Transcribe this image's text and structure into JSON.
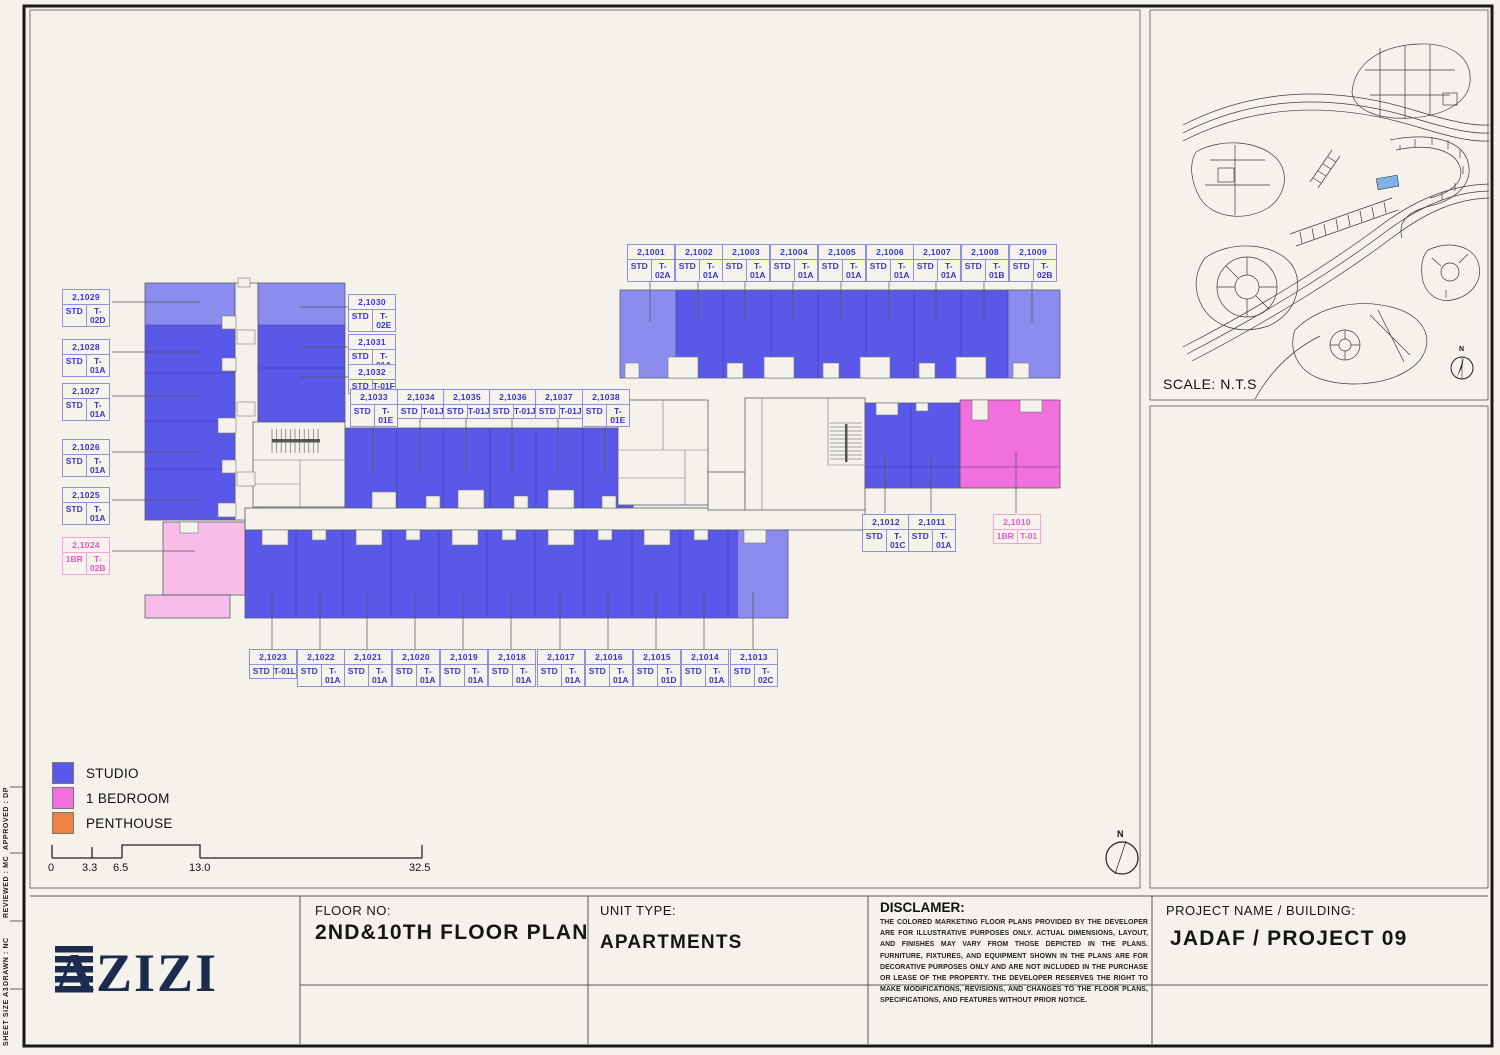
{
  "colors": {
    "paper": "#f4f2ea",
    "studio": "#5a58e8",
    "studio_light": "#8c8cee",
    "one_bed": "#f170dd",
    "one_bed_light": "#f8bce9",
    "penthouse": "#ee8345",
    "map_highlight": "#7fb3e3",
    "label_blue": "#3a35cf",
    "label_pink": "#ee55cc",
    "brand_navy": "#1d2b4f"
  },
  "margin_notes": [
    {
      "text": "APPROVED :   DP"
    },
    {
      "text": "REVIEWED :   MC"
    },
    {
      "text": "DRAWN :   NC"
    },
    {
      "text": "SHEET SIZE  A3"
    }
  ],
  "units": {
    "top": [
      {
        "id": "2,1001",
        "t": "STD",
        "p": "T-02A"
      },
      {
        "id": "2,1002",
        "t": "STD",
        "p": "T-01A"
      },
      {
        "id": "2,1003",
        "t": "STD",
        "p": "T-01A"
      },
      {
        "id": "2,1004",
        "t": "STD",
        "p": "T-01A"
      },
      {
        "id": "2,1005",
        "t": "STD",
        "p": "T-01A"
      },
      {
        "id": "2,1006",
        "t": "STD",
        "p": "T-01A"
      },
      {
        "id": "2,1007",
        "t": "STD",
        "p": "T-01A"
      },
      {
        "id": "2,1008",
        "t": "STD",
        "p": "T-01B"
      },
      {
        "id": "2,1009",
        "t": "STD",
        "p": "T-02B"
      }
    ],
    "left": [
      {
        "id": "2,1029",
        "t": "STD",
        "p": "T-02D"
      },
      {
        "id": "2,1028",
        "t": "STD",
        "p": "T-01A"
      },
      {
        "id": "2,1027",
        "t": "STD",
        "p": "T-01A"
      },
      {
        "id": "2,1026",
        "t": "STD",
        "p": "T-01A"
      },
      {
        "id": "2,1025",
        "t": "STD",
        "p": "T-01A"
      }
    ],
    "left1br": {
      "id": "2,1024",
      "t": "1BR",
      "p": "T-02B"
    },
    "mid_stack": [
      {
        "id": "2,1030",
        "t": "STD",
        "p": "T-02E"
      },
      {
        "id": "2,1031",
        "t": "STD",
        "p": "T-01A"
      },
      {
        "id": "2,1032",
        "t": "STD",
        "p": "T-01F"
      }
    ],
    "mid_row": [
      {
        "id": "2,1033",
        "t": "STD",
        "p": "T-01E"
      },
      {
        "id": "2,1034",
        "t": "STD",
        "p": "T-01J"
      },
      {
        "id": "2,1035",
        "t": "STD",
        "p": "T-01J"
      },
      {
        "id": "2,1036",
        "t": "STD",
        "p": "T-01J"
      },
      {
        "id": "2,1037",
        "t": "STD",
        "p": "T-01J"
      },
      {
        "id": "2,1038",
        "t": "STD",
        "p": "T-01E"
      }
    ],
    "bottom": [
      {
        "id": "2,1023",
        "t": "STD",
        "p": "T-01L"
      },
      {
        "id": "2,1022",
        "t": "STD",
        "p": "T-01A"
      },
      {
        "id": "2,1021",
        "t": "STD",
        "p": "T-01A"
      },
      {
        "id": "2,1020",
        "t": "STD",
        "p": "T-01A"
      },
      {
        "id": "2,1019",
        "t": "STD",
        "p": "T-01A"
      },
      {
        "id": "2,1018",
        "t": "STD",
        "p": "T-01A"
      },
      {
        "id": "2,1017",
        "t": "STD",
        "p": "T-01A"
      },
      {
        "id": "2,1016",
        "t": "STD",
        "p": "T-01A"
      },
      {
        "id": "2,1015",
        "t": "STD",
        "p": "T-01D"
      },
      {
        "id": "2,1014",
        "t": "STD",
        "p": "T-01A"
      },
      {
        "id": "2,1013",
        "t": "STD",
        "p": "T-02C"
      }
    ],
    "right": [
      {
        "id": "2,1012",
        "t": "STD",
        "p": "T-01C"
      },
      {
        "id": "2,1011",
        "t": "STD",
        "p": "T-01A"
      }
    ],
    "right1br": {
      "id": "2,1010",
      "t": "1BR",
      "p": "T-01"
    }
  },
  "legend": {
    "items": [
      {
        "label": "STUDIO",
        "color": "#5a58e8"
      },
      {
        "label": "1 BEDROOM",
        "color": "#f170dd"
      },
      {
        "label": "PENTHOUSE",
        "color": "#ee8345"
      }
    ]
  },
  "scalebar": {
    "labels": [
      "0",
      "3.3",
      "6.5",
      "13.0",
      "32.5"
    ]
  },
  "map": {
    "scale_note": "SCALE: N.T.S",
    "north": "N"
  },
  "compass": {
    "north": "N"
  },
  "titleblock": {
    "floor_label": "FLOOR NO:",
    "floor_value": "2ND&10TH FLOOR PLAN",
    "unit_type_label": "UNIT TYPE:",
    "unit_type_value": "APARTMENTS",
    "disclaimer_label": "DISCLAMER:",
    "disclaimer_text": "THE COLORED MARKETING FLOOR PLANS PROVIDED BY THE DEVELOPER ARE FOR ILLUSTRATIVE PURPOSES ONLY. ACTUAL DIMENSIONS, LAYOUT, AND FINISHES MAY VARY FROM THOSE DEPICTED IN THE PLANS. FURNITURE, FIXTURES, AND EQUIPMENT SHOWN IN THE PLANS ARE FOR DECORATIVE PURPOSES ONLY AND ARE NOT INCLUDED IN THE PURCHASE OR LEASE OF THE PROPERTY. THE DEVELOPER RESERVES THE RIGHT TO MAKE MODIFICATIONS, REVISIONS, AND CHANGES TO THE FLOOR PLANS, SPECIFICATIONS, AND FEATURES WITHOUT PRIOR NOTICE.",
    "project_label": "PROJECT NAME / BUILDING:",
    "project_value": "JADAF / PROJECT 09",
    "brand": "AZIZI"
  }
}
